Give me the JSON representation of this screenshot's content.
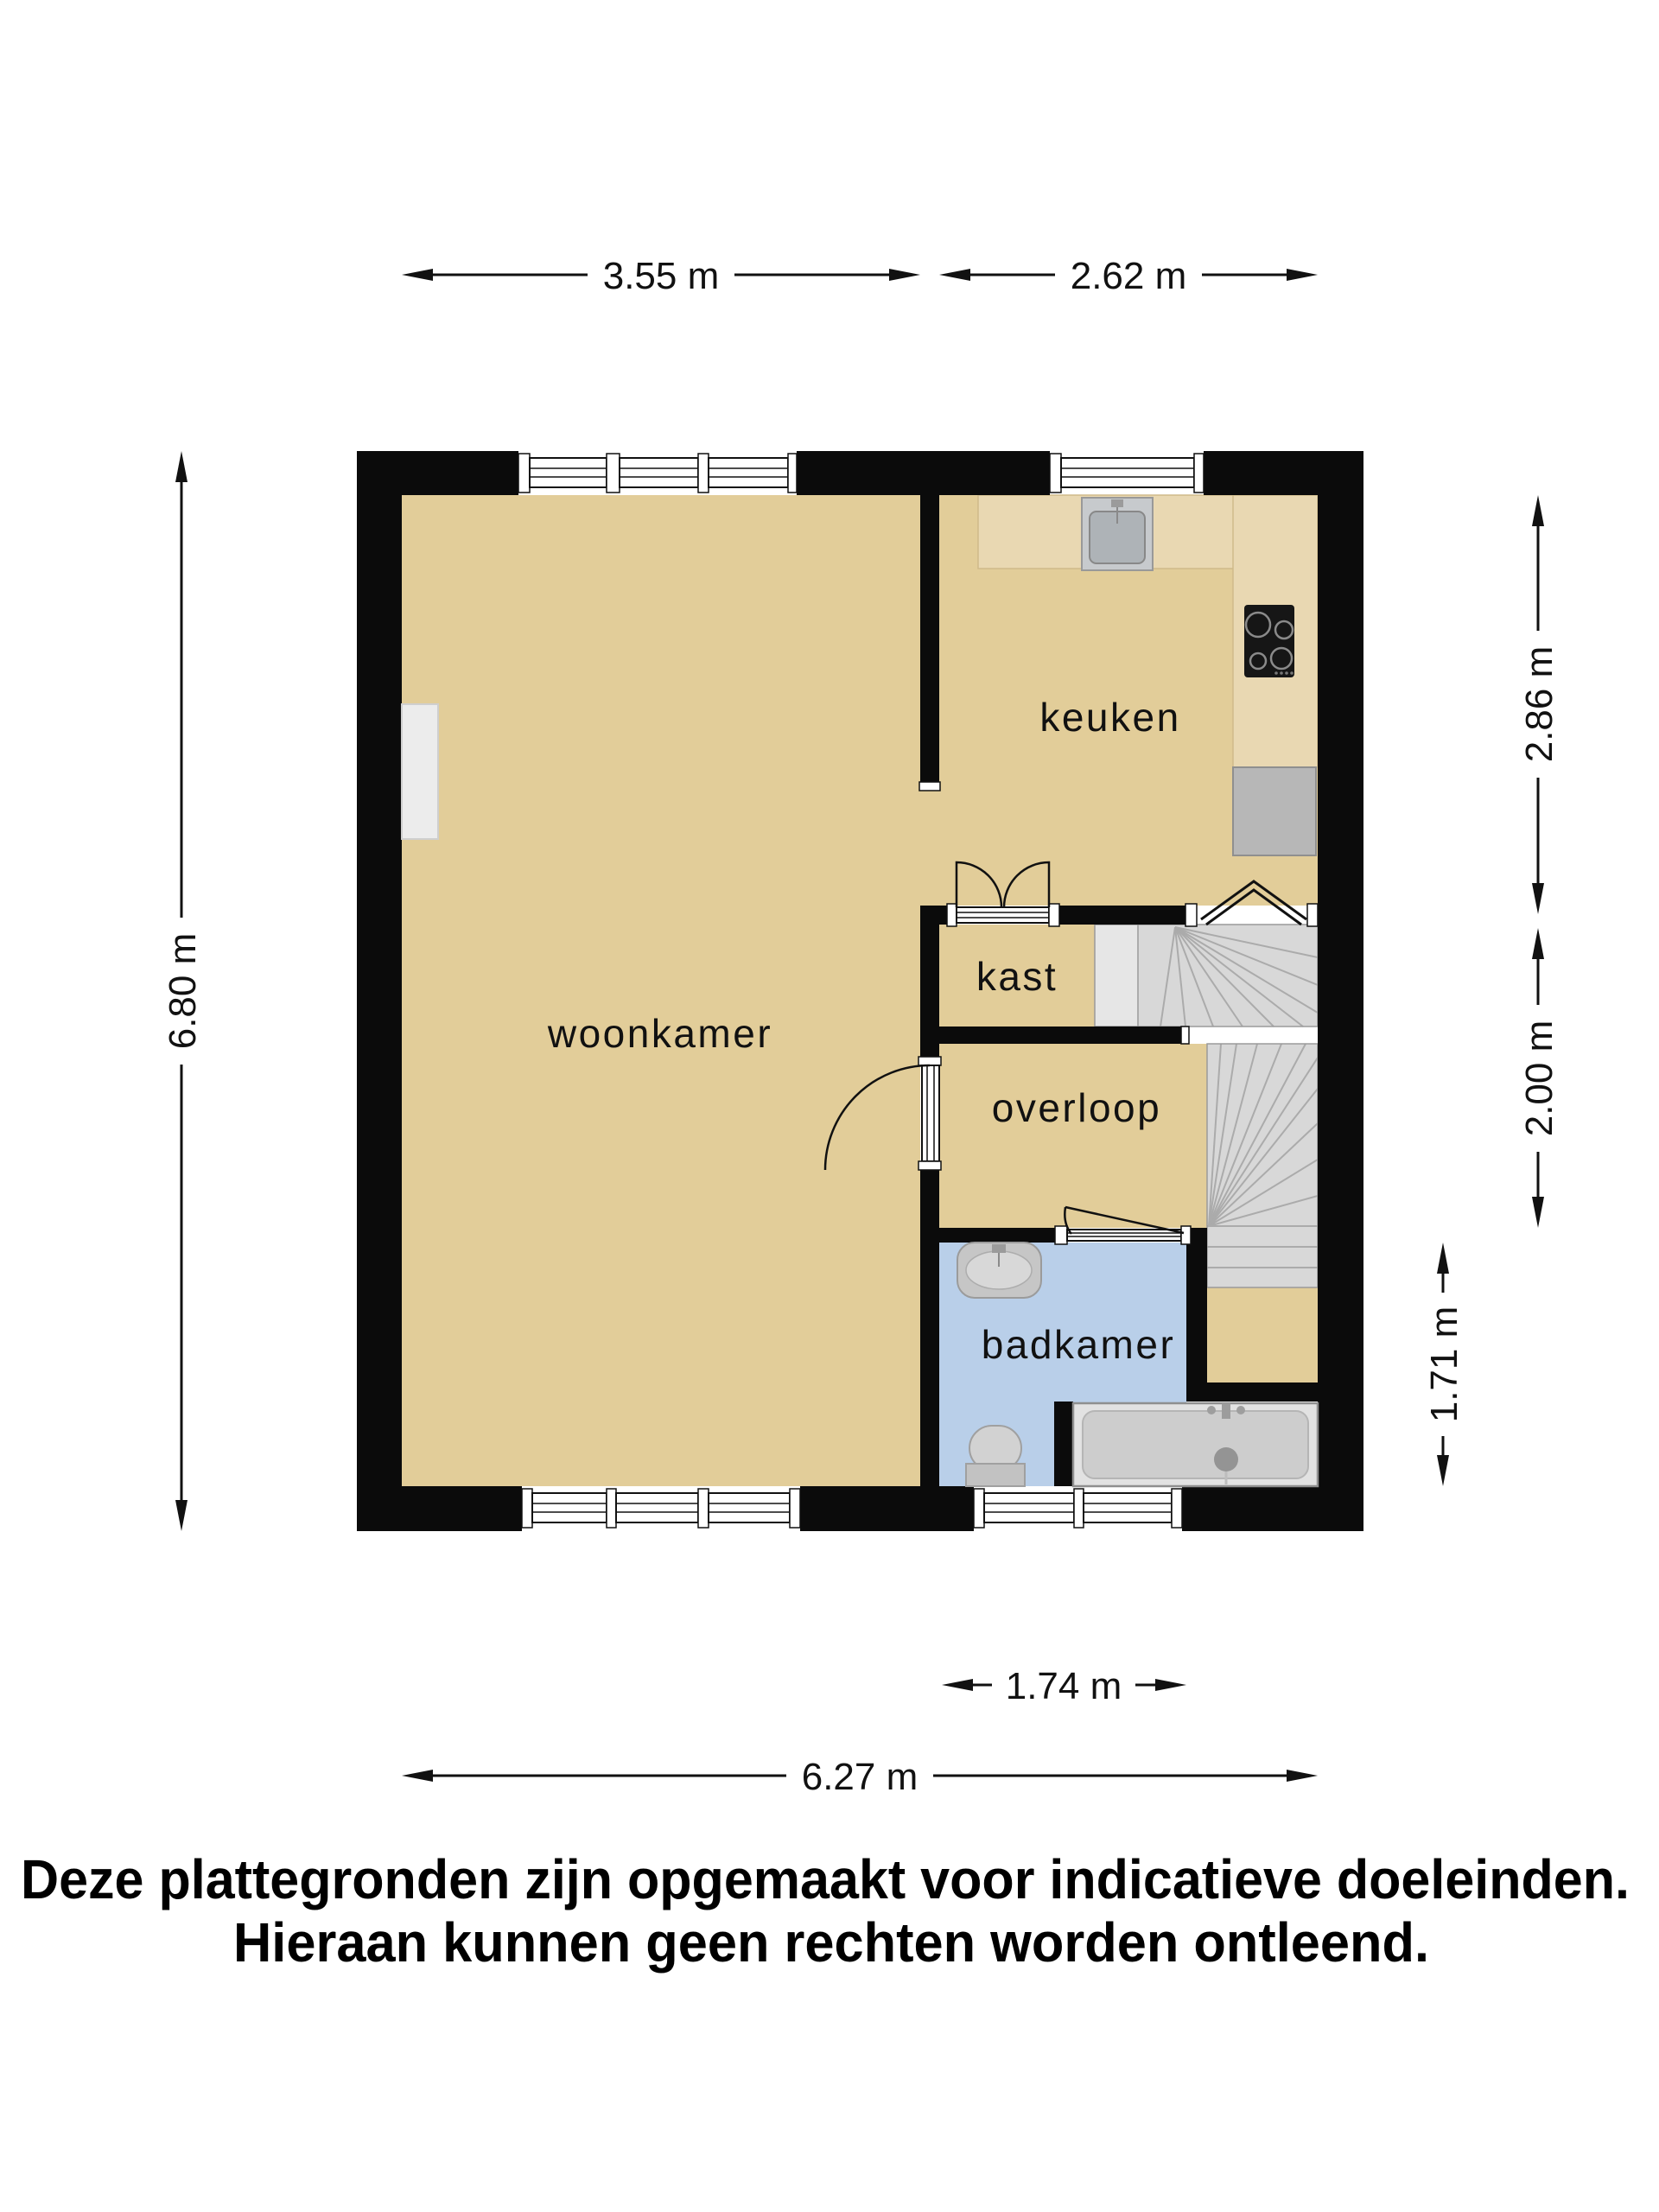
{
  "rooms": {
    "woonkamer": "woonkamer",
    "keuken": "keuken",
    "kast": "kast",
    "overloop": "overloop",
    "badkamer": "badkamer"
  },
  "dimensions": {
    "top_left_width": "3.55 m",
    "top_right_width": "2.62 m",
    "left_height": "6.80 m",
    "kitchen_depth": "2.86 m",
    "landing_depth": "2.00 m",
    "bathroom_depth": "1.71 m",
    "bathroom_width": "1.74 m",
    "total_width": "6.27 m"
  },
  "disclaimer": {
    "line1": "Deze plattegronden zijn opgemaakt voor indicatieve doeleinden.",
    "line2": "Hieraan kunnen geen rechten worden ontleend."
  },
  "colors": {
    "wall": "#0b0b0b",
    "floor": "#e2cd99",
    "bathroom_floor": "#b9cfe9",
    "stairs": "#d8d8d8",
    "counter": "#e9d8b2",
    "appliance": "#b7b7b7"
  }
}
